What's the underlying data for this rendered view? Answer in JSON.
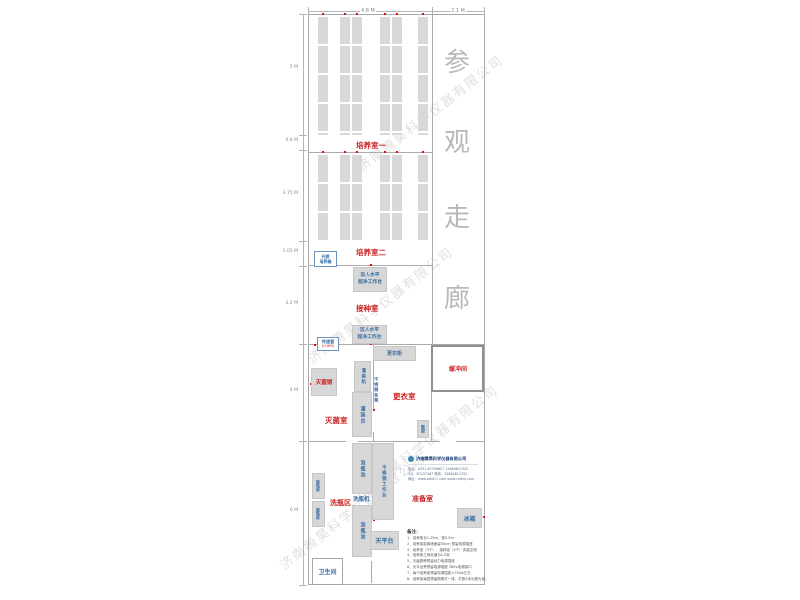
{
  "dimensions": {
    "top": [
      "4.8 M",
      "2.1 M"
    ],
    "left": [
      "5 M",
      "0.6 M",
      "3.75 M",
      "1.05 M",
      "3.2 M",
      "4 M",
      "6 M"
    ]
  },
  "corridor": {
    "c0": "参",
    "c1": "观",
    "c2": "走",
    "c3": "廊"
  },
  "rooms": {
    "culture1": "培养室一",
    "culture2": "培养室二",
    "inoculation": "接种室",
    "changing": "更衣室",
    "sterilization": "灭菌室",
    "buffer": "缓冲间",
    "washing": "洗瓶区",
    "preparation": "准备室",
    "toilet": "卫生间"
  },
  "equipment": {
    "light_incubator_l1": "光照",
    "light_incubator_l2": "培养箱",
    "bench_l1": "双人水平",
    "bench_l2": "超净工作台",
    "pass_window": "传递窗",
    "pass_window_size": "(0.6M)",
    "locker": "更衣柜",
    "autoclave": "灭菌锅",
    "filling_machine": "灌装机",
    "steel_bench": "不锈钢条凳",
    "filling_table": "灌装台",
    "shoe_rack": "鞋架",
    "soak_pool": "泡瓶池",
    "steel_worktable": "不锈钢工作台",
    "bottle_washer": "洗瓶机",
    "dry_rack": "晾瓶架",
    "fridge": "冰箱",
    "balance_table": "天平台"
  },
  "company": {
    "name": "济南腾昊科学仪器有限公司",
    "phone": "电话：0531-87799627  15864612352",
    "qq": "QQ：87437487  微信：15864612352",
    "web": "网址：www.sdth17.com  www.cnthkj.com"
  },
  "notes": {
    "header": "备注：",
    "items": [
      "1、培养架长1.25m，宽0.5m",
      "2、培养架距离墙面留30cm 预留电源插座",
      "3、培养室（3个）、接种室（2个）安装空调",
      "4、培养架之间走道为1.0米",
      "5、灭菌锅旁预留动力电源插座",
      "6、天平台旁预留电源插座 380v电源接口",
      "7、每个培养架预留电源插座×750w左右",
      "8、培养架每层预留照明灯一排，灯数4米长度为宜。"
    ]
  },
  "watermark": {
    "text": "济南腾昊科学仪器有限公司"
  }
}
